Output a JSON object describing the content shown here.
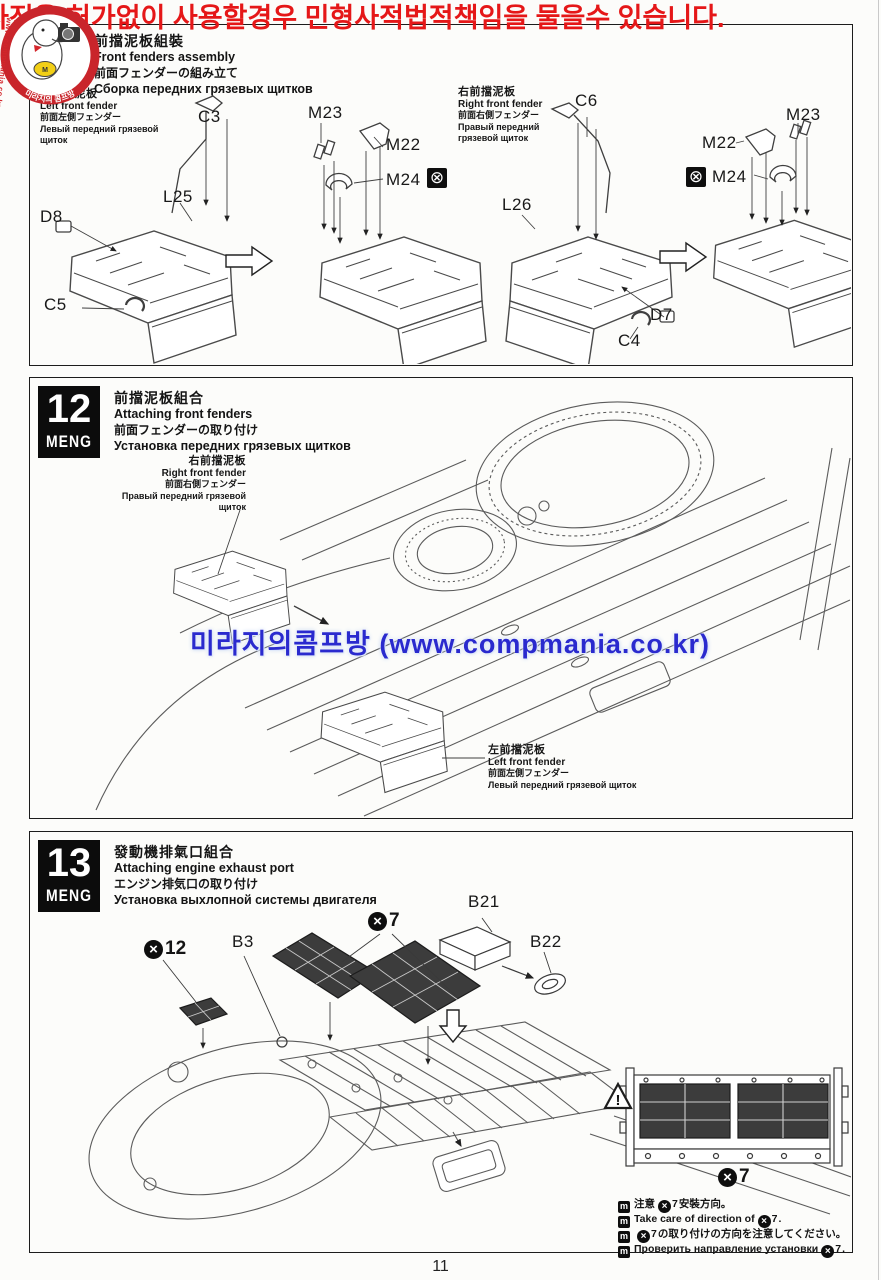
{
  "page_number": "11",
  "watermarks": {
    "top_notice": "사진을 허가없이 사용할경우 민형사적법적책임을 물을수 있습니다.",
    "logo_title": "미라지의 콤프방",
    "logo_site": "www.compmania.co.kr",
    "center_notice": "미라지의콤프방 (www.compmania.co.kr)"
  },
  "colors": {
    "notice_red": "#e51718",
    "watermark_blue": "#2a2ace",
    "logo_red": "#c9252b",
    "mesh_dark": "#3c3c3c",
    "line_art": "#4a4a4a"
  },
  "icons": {
    "x_mark": "×",
    "no_glue": "⊗",
    "meng_mini": "m",
    "exclaim": "!",
    "logo_m": "M"
  },
  "fenders_assembly": {
    "title_zh": "前擋泥板組裝",
    "title_en": "Front fenders assembly",
    "title_ja": "前面フェンダーの組み立て",
    "title_ru": "Сборка передних грязевых щитков",
    "left_fender_zh": "左前擋泥板",
    "left_fender_en": "Left front fender",
    "left_fender_ja": "前面左側フェンダー",
    "left_fender_ru": "Левый передний грязевой щиток",
    "right_fender_zh": "右前擋泥板",
    "right_fender_en": "Right front fender",
    "right_fender_ja": "前面右側フェンダー",
    "right_fender_ru": "Правый передний грязевой щиток",
    "parts": {
      "C3": "C3",
      "D8": "D8",
      "L25": "L25",
      "C5": "C5",
      "M22": "M22",
      "M23": "M23",
      "M24": "M24",
      "C6": "C6",
      "L26": "L26",
      "D7": "D7",
      "C4": "C4"
    }
  },
  "step12": {
    "number": "12",
    "brand": "MENG",
    "title_zh": "前擋泥板組合",
    "title_en": "Attaching front fenders",
    "title_ja": "前面フェンダーの取り付け",
    "title_ru": "Установка передних грязевых щитков",
    "right_fender_zh": "右前擋泥板",
    "right_fender_en": "Right front fender",
    "right_fender_ja": "前面右側フェンダー",
    "right_fender_ru": "Правый передний грязевой щиток",
    "left_fender_zh": "左前擋泥板",
    "left_fender_en": "Left front fender",
    "left_fender_ja": "前面左側フェンダー",
    "left_fender_ru": "Левый передний грязевой щиток"
  },
  "step13": {
    "number": "13",
    "brand": "MENG",
    "title_zh": "發動機排氣口組合",
    "title_en": "Attaching engine exhaust port",
    "title_ja": "エンジン排気口の取り付け",
    "title_ru": "Установка выхлопной системы двигателя",
    "qty_x12": "12",
    "qty_x7": "7",
    "inset_qty_x7": "7",
    "parts": {
      "B3": "B3",
      "B21": "B21",
      "B22": "B22"
    },
    "notes": [
      {
        "pre": "注意",
        "qty": "7",
        "post": "安裝方向。"
      },
      {
        "pre": "Take care of direction of",
        "qty": "7",
        "post": "."
      },
      {
        "pre": "",
        "qty": "7",
        "post": "の取り付けの方向を注意してください。"
      },
      {
        "pre": "Проверить направление установки",
        "qty": "7",
        "post": "."
      }
    ]
  }
}
